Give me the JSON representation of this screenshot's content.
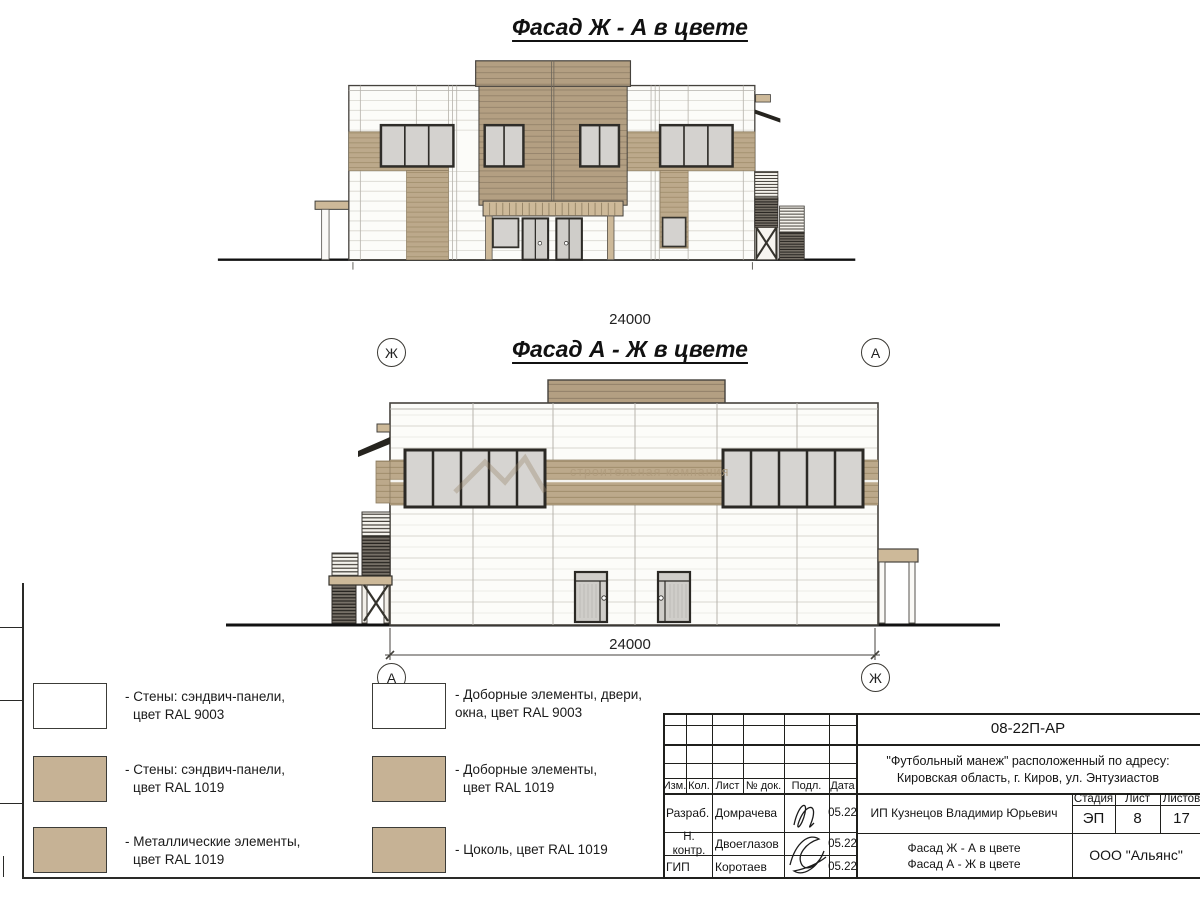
{
  "facade1": {
    "title": "Фасад Ж - А в цвете",
    "dimension": "24000",
    "axis_left": "Ж",
    "axis_right": "А"
  },
  "facade2": {
    "title": "Фасад А - Ж в цвете",
    "dimension": "24000",
    "axis_left": "А",
    "axis_right": "Ж"
  },
  "watermark": {
    "text": "строительная компания"
  },
  "legend": {
    "left": [
      {
        "color": "#ffffff",
        "line1": "- Стены: сэндвич-панели,",
        "line2": "цвет RAL 9003"
      },
      {
        "color": "#c6b295",
        "line1": "- Стены: сэндвич-панели,",
        "line2": "цвет RAL 1019"
      },
      {
        "color": "#c6b295",
        "line1": "- Металлические элементы,",
        "line2": "цвет RAL 1019"
      }
    ],
    "right": [
      {
        "color": "#ffffff",
        "line1": "- Доборные элементы, двери,",
        "line2": "окна, цвет RAL 9003"
      },
      {
        "color": "#c6b295",
        "line1": "- Доборные элементы,",
        "line2": "цвет RAL 1019"
      },
      {
        "color": "#c6b295",
        "line1": "- Цоколь, цвет RAL 1019",
        "line2": ""
      }
    ]
  },
  "title_block": {
    "doc_code": "08-22П-АР",
    "address_line1": "\"Футбольный манеж\" расположенный по адресу:",
    "address_line2": "Кировская область, г. Киров, ул. Энтузиастов",
    "customer": "ИП Кузнецов Владимир Юрьевич",
    "stage_label": "Стадия",
    "sheet_label": "Лист",
    "sheets_label": "Листов",
    "stage_value": "ЭП",
    "sheet_value": "8",
    "sheets_value": "17",
    "sheet_title_line1": "Фасад Ж - А в цвете",
    "sheet_title_line2": "Фасад А - Ж в цвете",
    "company": "ООО \"Альянс\"",
    "header": {
      "izm": "Изм.",
      "kol": "Кол.",
      "list": "Лист",
      "doc": "№ док.",
      "podp": "Подл.",
      "date": "Дата"
    },
    "staff": [
      {
        "role": "Разраб.",
        "name": "Домрачева",
        "date": "05.22"
      },
      {
        "role": "Н. контр.",
        "name": "Двоеглазов",
        "date": "05.22"
      },
      {
        "role": "ГИП",
        "name": "Коротаев",
        "date": "05.22"
      }
    ]
  },
  "colors": {
    "panel_tan": "#bca98b",
    "tower_tan": "#b39f82",
    "trim_tan": "#cdb999",
    "glass": "#d4d2cf",
    "frame_dark": "#2b2925"
  }
}
